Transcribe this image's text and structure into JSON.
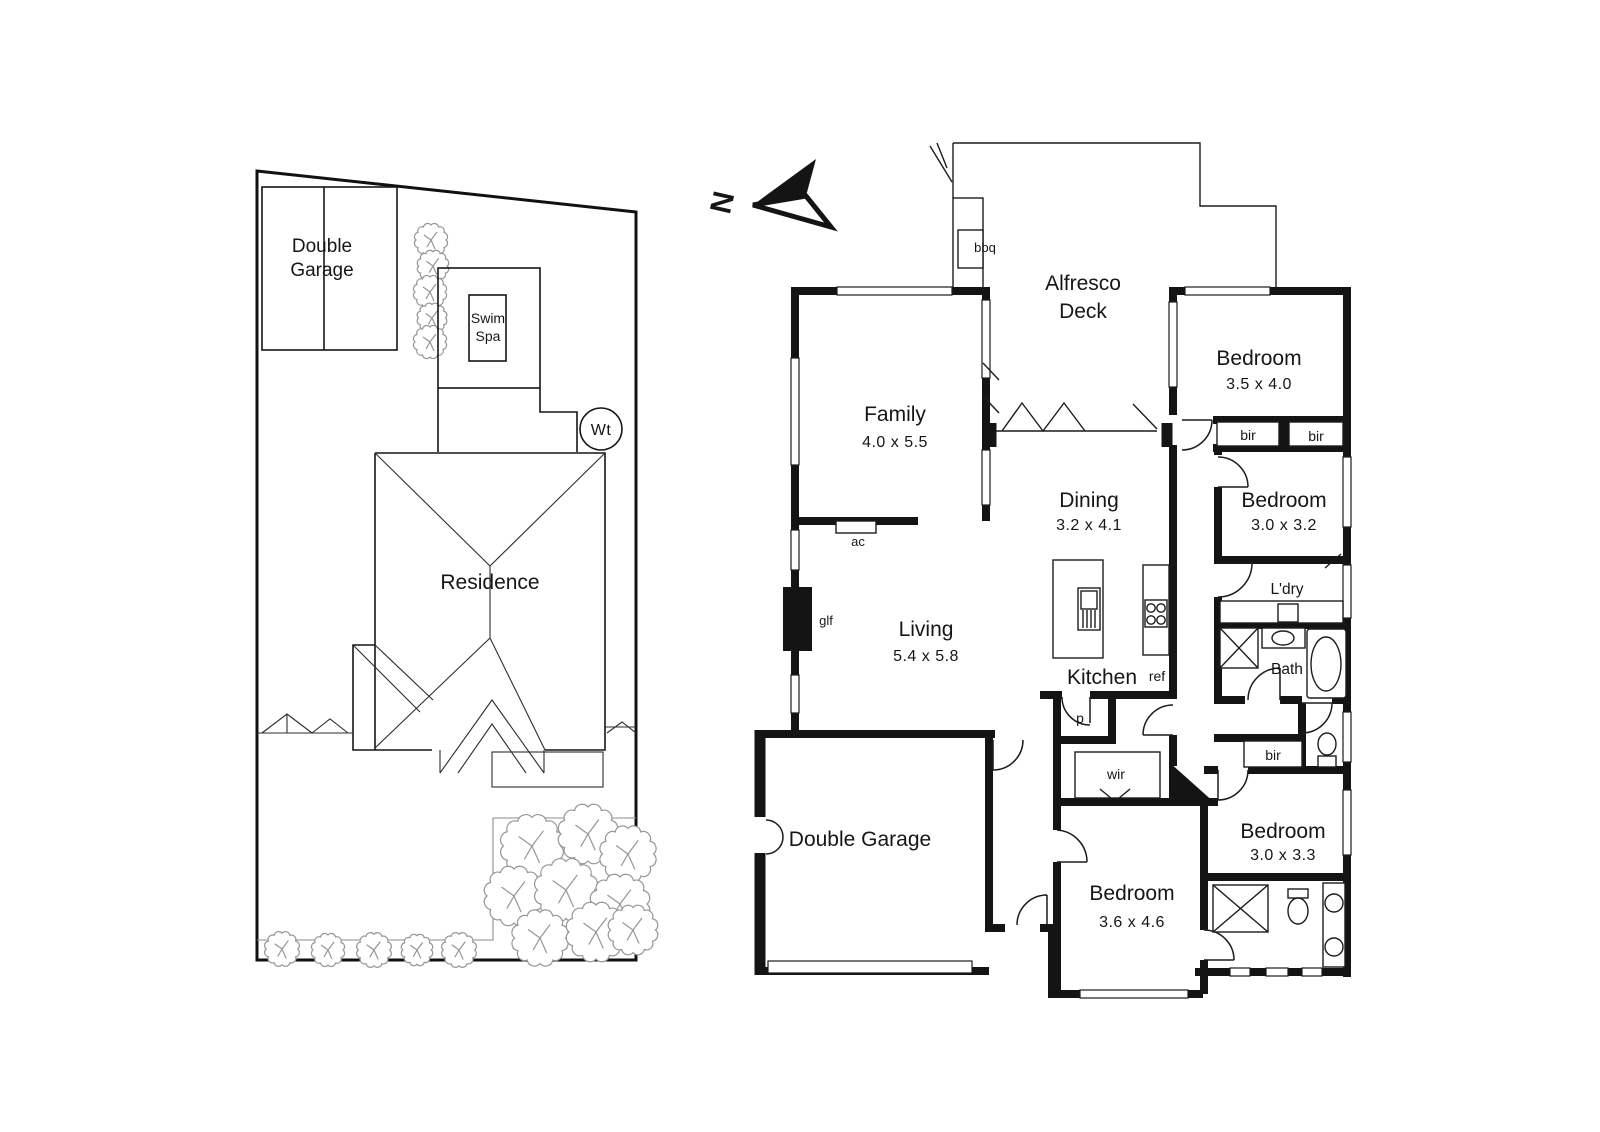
{
  "page": {
    "background": "#ffffff",
    "wall_color": "#141414",
    "line_color": "#1c1c1c",
    "tree_color": "#969696"
  },
  "north_arrow": {
    "label": "N"
  },
  "site_plan": {
    "double_garage_line1": "Double",
    "double_garage_line2": "Garage",
    "swim_spa_line1": "Swim",
    "swim_spa_line2": "Spa",
    "water_tank": "Wt",
    "residence": "Residence"
  },
  "floor_plan": {
    "alfresco_line1": "Alfresco",
    "alfresco_line2": "Deck",
    "family": {
      "name": "Family",
      "dims": "4.0 x 5.5"
    },
    "bedroom1": {
      "name": "Bedroom",
      "dims": "3.5 x 4.0"
    },
    "dining": {
      "name": "Dining",
      "dims": "3.2 x 4.1"
    },
    "bedroom2": {
      "name": "Bedroom",
      "dims": "3.0 x 3.2"
    },
    "living": {
      "name": "Living",
      "dims": "5.4 x 5.8"
    },
    "kitchen": {
      "name": "Kitchen"
    },
    "laundry": {
      "name": "L'dry"
    },
    "bath": {
      "name": "Bath"
    },
    "garage": {
      "name": "Double Garage"
    },
    "bedroom3": {
      "name": "Bedroom",
      "dims": "3.0 x 3.3"
    },
    "bedroom4": {
      "name": "Bedroom",
      "dims": "3.6 x 4.6"
    },
    "labels": {
      "bbq": "bbq",
      "ac": "ac",
      "glf": "glf",
      "ref": "ref",
      "p": "p",
      "wir": "wir",
      "bir": "bir"
    }
  }
}
